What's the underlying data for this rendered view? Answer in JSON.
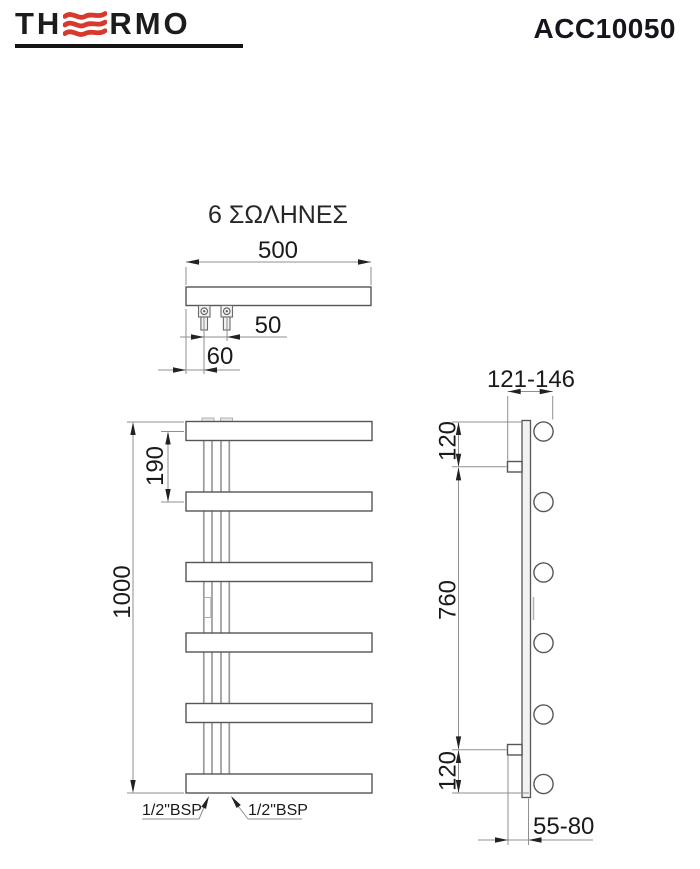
{
  "header": {
    "logo_part1": "TH",
    "logo_part2": "RMO",
    "product_code": "ACC10050"
  },
  "title": "6 ΣΩΛΗΝΕΣ",
  "top_view": {
    "width": "500",
    "pipe_spacing": "50",
    "edge_offset": "60"
  },
  "front_view": {
    "height": "1000",
    "tube_pitch": "190",
    "bsp_left": "1/2\"BSP",
    "bsp_right": "1/2\"BSP",
    "tube_count": "6"
  },
  "side_view": {
    "wall_to_tube_center": "121-146",
    "top_tube_offset": "120",
    "bracket_span": "760",
    "bottom_tube_offset": "120",
    "wall_clearance": "55-80"
  },
  "colors": {
    "accent_red": "#d8392c",
    "outline_gray": "#565656",
    "dimline_gray": "#8f8f8f",
    "text_dark": "#1a1a1a"
  }
}
